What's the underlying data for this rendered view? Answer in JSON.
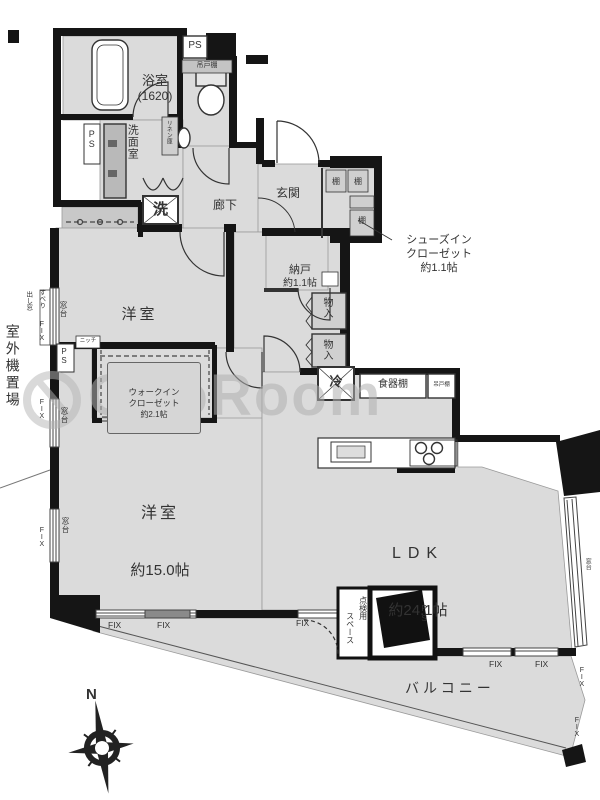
{
  "watermark": {
    "text": "GooRoom"
  },
  "compass": {
    "north": "N"
  },
  "rooms": {
    "bathroom_name": "浴室",
    "bathroom_size": "(1620)",
    "washroom": "洗面室",
    "hallway": "廊下",
    "entrance": "玄関",
    "shoes_closet_l1": "シューズイン",
    "shoes_closet_l2": "クローゼット",
    "shoes_closet_l3": "約1.1帖",
    "storage_name": "納戸",
    "storage_size": "約1.1帖",
    "west_small_name": "洋室",
    "west_small_size": "約5.7帖",
    "wic_l1": "ウォークイン",
    "wic_l2": "クローゼット",
    "wic_l3": "約2.1帖",
    "west_large_name": "洋室",
    "west_large_size": "約15.0帖",
    "ldk_name": "LDK",
    "ldk_size": "約24.1帖",
    "balcony": "バルコニー",
    "outdoor_unit": "室外機置場",
    "inspection_l1": "点検用",
    "inspection_l2": "スペース"
  },
  "fixtures": {
    "washing_machine": "洗",
    "refrigerator": "冷",
    "cupboard": "食器棚",
    "hanging_cupboard": "吊戸棚",
    "linen": "リネン庫",
    "shelf": "棚",
    "closet": "物入",
    "niche": "ニッチ",
    "window_sill": "窓台"
  },
  "labels": {
    "ps": "PS",
    "fix": "FIX",
    "awning_l1": "すべり",
    "awning_l2": "出し窓"
  }
}
